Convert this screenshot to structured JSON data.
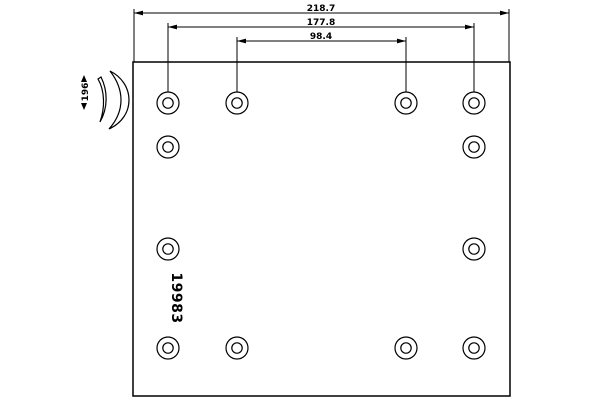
{
  "drawing": {
    "type": "brake-lining-technical-drawing",
    "part_number": "19983",
    "dimensions": {
      "overall_length": "218.7",
      "outer_rivet_spacing": "177.8",
      "inner_rivet_spacing": "98.4",
      "lining_width": "196"
    },
    "rivet_hole_count": 12,
    "colors": {
      "line": "#000000",
      "background": "#ffffff"
    }
  }
}
